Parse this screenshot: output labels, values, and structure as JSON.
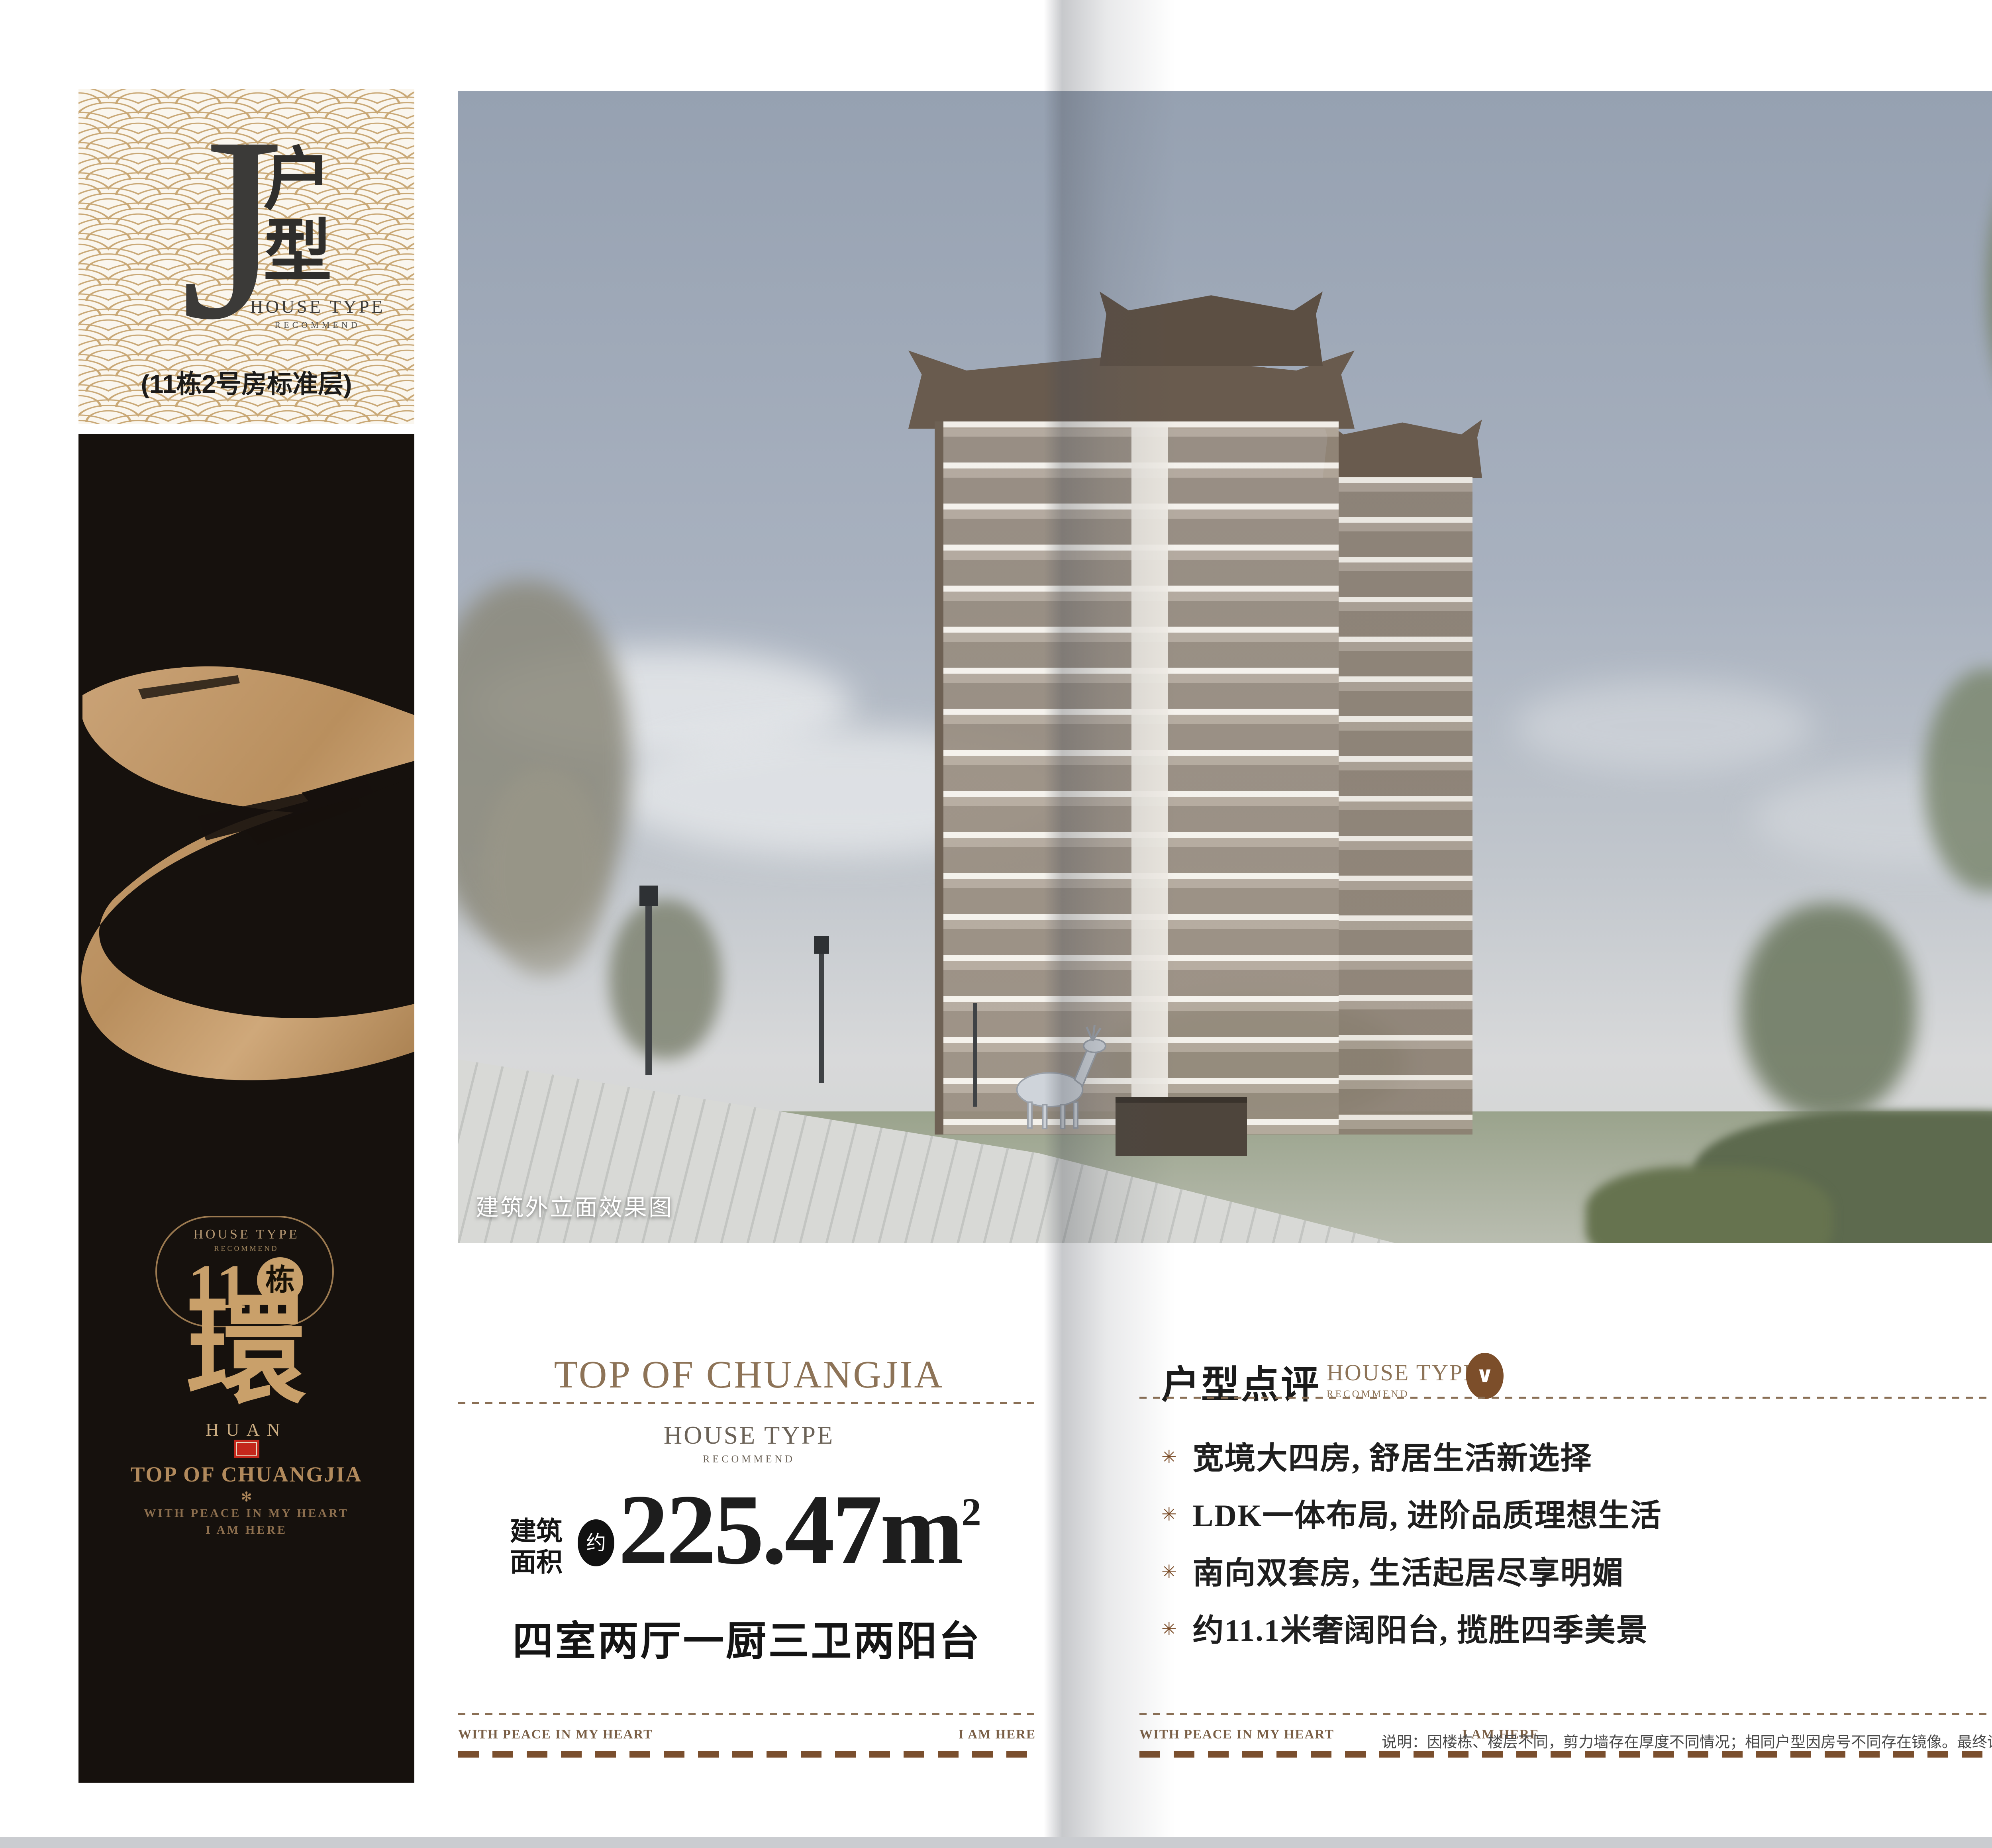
{
  "type_card": {
    "letter": "J",
    "name_vertical": "户型",
    "house_type": "HOUSE TYPE",
    "recommend": "RECOMMEND",
    "subtitle": "(11栋2号房标准层)"
  },
  "banner": {
    "house_type": "HOUSE TYPE",
    "recommend": "RECOMMEND",
    "building_no": "11",
    "building_unit": "栋",
    "calligraphy": "環",
    "pinyin": "HUAN",
    "brand": "TOP OF CHUANGJIA",
    "star": "✻",
    "slogan_line1": "WITH PEACE IN MY HEART",
    "slogan_line2": "I AM HERE"
  },
  "photo": {
    "caption": "建筑外立面效果图"
  },
  "area_block": {
    "brand": "TOP OF CHUANGJIA",
    "house_type": "HOUSE TYPE",
    "recommend": "RECOMMEND",
    "area_label_1": "建筑",
    "area_label_2": "面积",
    "approx": "约",
    "area_value": "225.47m",
    "area_sup": "2",
    "layout": "四室两厅一厨三卫两阳台"
  },
  "footer_left": {
    "left": "WITH PEACE IN MY HEART",
    "right": "I AM HERE"
  },
  "review": {
    "title": "户型点评",
    "house_type": "HOUSE TYPE",
    "recommend": "RECOMMEND",
    "bullet_icon": "✳",
    "bullets": [
      "宽境大四房, 舒居生活新选择",
      "LDK一体布局, 进阶品质理想生活",
      "南向双套房, 生活起居尽享明媚",
      "约11.1米奢阔阳台, 揽胜四季美景"
    ],
    "foot_left": "WITH PEACE IN MY HEART",
    "foot_center": "I AM HERE",
    "note": "说明：因楼栋、楼层不同，剪力墙存在厚度不同情况；相同户型因房号不同存在镜像。最终请以实际交付为准。"
  },
  "unit_page": {
    "logo_line1": "TOP OF",
    "logo_star": "*",
    "logo_line2": "CHUANGJIA",
    "tagline": [
      "THE ULTIMATE",
      "REAL ESTATE PROJECT",
      "REPRESENTING",
      "TRANQUILITY"
    ],
    "title": "户型平面图",
    "title_en": "Unit Plan",
    "legend": "半计入产权面积",
    "plan": {
      "rooms": [
        "阳台",
        "卫生间",
        "卧室",
        "卫生间",
        "厨房",
        "餐厅",
        "主卧",
        "卧室",
        "客厅",
        "卫生间",
        "卧室",
        "阳台"
      ],
      "dims_right": [
        "约1600",
        "约3800",
        "约6500",
        "约1900"
      ],
      "dims_bottom": [
        "约4300",
        "约3500",
        "约7200",
        "约3900"
      ]
    },
    "sections": {
      "structure_title": "户型结构",
      "structure_en": "House type structure",
      "placement_title": "户型落位",
      "placement_en": "House type placement"
    },
    "site": {
      "buildings": [
        {
          "badge": "3幢",
          "units": [
            "1",
            "2",
            "3",
            "4"
          ]
        },
        {
          "badge": "5幢",
          "units": [
            "1",
            "2"
          ]
        },
        {
          "badge": "2幢",
          "units": [
            "2",
            "1"
          ]
        },
        {
          "badge": "11幢",
          "units": [
            "2",
            "1"
          ],
          "highlight_unit": "2"
        },
        {
          "badge": "10幢",
          "units": [
            "4",
            "3",
            "2",
            "1"
          ]
        }
      ]
    },
    "disclaimer": "本广告文字图片仅作要约邀请，不作为双方签署《商品房买卖合同》及补充协议的内容，实际以双方签署的《商品房买卖合同》及补充协议为准。开发商：创佳地产。设计时间：2025年5月20日；有效时间：2025年12月30日"
  },
  "colors": {
    "accent_brown": "#8d7357",
    "dash_brown": "#8a6f55",
    "heavy_dash": "#7a4f2e",
    "gold": "#c8a06b",
    "pattern_gold": "#c9a876",
    "banner_black": "#16110d",
    "seal_red": "#c3271b",
    "badge_red": "#d3302a",
    "legend_yellow": "#e6c621",
    "site_green": "#d9e8ca",
    "highlight_tan": "#b08b63"
  }
}
